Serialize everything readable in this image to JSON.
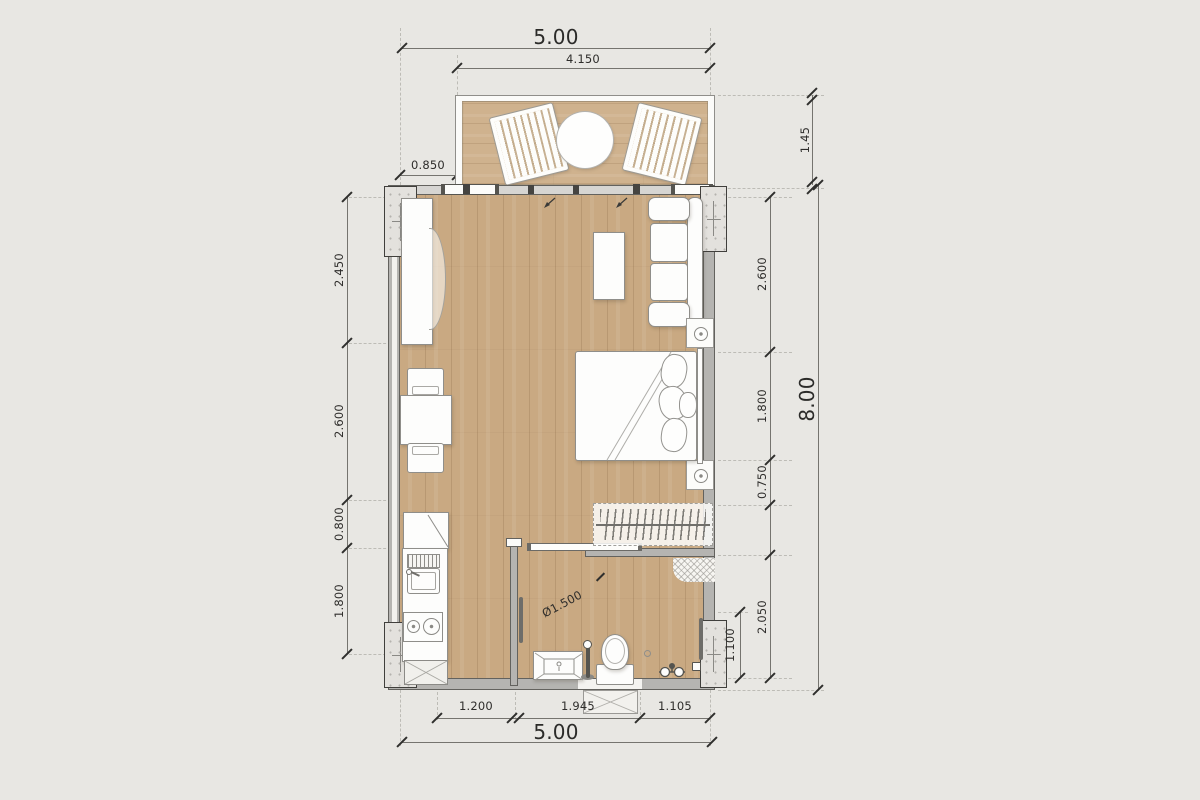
{
  "drawing_title": "studio-unit-floor-plan",
  "dims": {
    "top_total": "5.00",
    "top_inner": "4.150",
    "offset_left": "0.850",
    "balcony_depth": "1.45",
    "left": [
      "2.450",
      "2.600",
      "0.800",
      "1.800"
    ],
    "right": [
      "2.600",
      "1.800",
      "0.750",
      "2.050",
      "1.100"
    ],
    "height_total": "8.00",
    "bottom": [
      "1.200",
      "1.945",
      "1.105"
    ],
    "bottom_total": "5.00",
    "clearance": "Ø1.500"
  },
  "colors": {
    "background": "#e8e7e3",
    "floor_wood": "#c9a982",
    "balcony_wood": "#cfb28e",
    "wall_gray": "#b5b4b1",
    "outline_dark": "#63625e",
    "furniture_white": "#fdfdfc",
    "dim_text": "#2e2d2b"
  }
}
